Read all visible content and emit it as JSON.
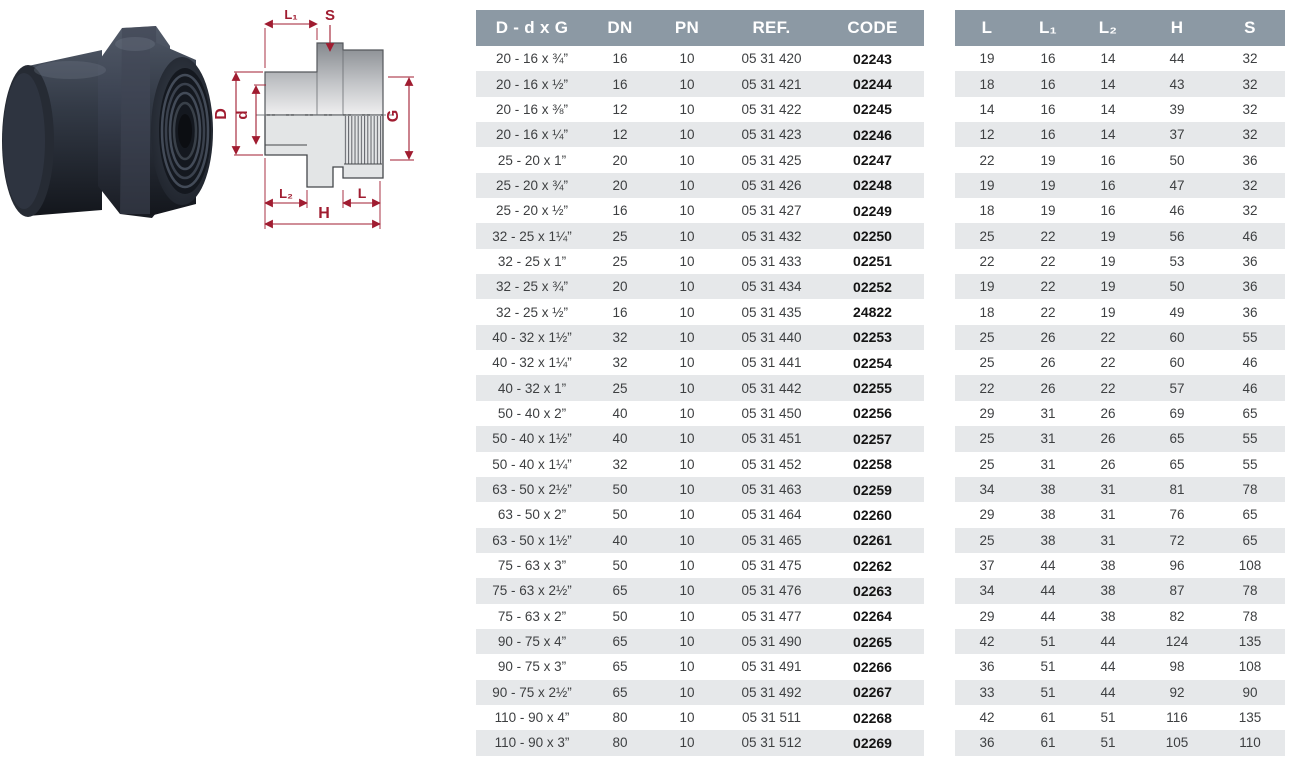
{
  "page": {
    "background": "#ffffff"
  },
  "colors": {
    "table_header_bg": "#8C99A4",
    "row_stripe": "#E6E8EA",
    "cell_text": "#3d3f41",
    "code_text": "#141414",
    "dimension_red": "#A01C30",
    "fitting_dark": "#272C36",
    "drawing_body_gray": "#9DA1A5"
  },
  "drawing": {
    "labels": {
      "l1": "L₁",
      "s": "S",
      "D": "D",
      "d": "d",
      "g": "G",
      "l2": "L₂",
      "l": "L",
      "h": "H"
    }
  },
  "spec_table": {
    "headers": [
      "D - d x G",
      "DN",
      "PN",
      "REF.",
      "CODE"
    ],
    "rows": [
      [
        "20 - 16 x ¾”",
        "16",
        "10",
        "05 31 420",
        "02243"
      ],
      [
        "20 - 16 x ½”",
        "16",
        "10",
        "05 31 421",
        "02244"
      ],
      [
        "20 - 16 x ⅜”",
        "12",
        "10",
        "05 31 422",
        "02245"
      ],
      [
        "20 - 16 x ¼”",
        "12",
        "10",
        "05 31 423",
        "02246"
      ],
      [
        "25 - 20 x 1”",
        "20",
        "10",
        "05 31 425",
        "02247"
      ],
      [
        "25 - 20 x ¾”",
        "20",
        "10",
        "05 31 426",
        "02248"
      ],
      [
        "25 - 20 x ½”",
        "16",
        "10",
        "05 31 427",
        "02249"
      ],
      [
        "32 - 25 x 1¼”",
        "25",
        "10",
        "05 31 432",
        "02250"
      ],
      [
        "32 - 25 x 1”",
        "25",
        "10",
        "05 31 433",
        "02251"
      ],
      [
        "32 - 25 x ¾”",
        "20",
        "10",
        "05 31 434",
        "02252"
      ],
      [
        "32 - 25 x ½”",
        "16",
        "10",
        "05 31 435",
        "24822"
      ],
      [
        "40 - 32 x 1½”",
        "32",
        "10",
        "05 31 440",
        "02253"
      ],
      [
        "40 - 32 x 1¼”",
        "32",
        "10",
        "05 31 441",
        "02254"
      ],
      [
        "40 - 32 x 1”",
        "25",
        "10",
        "05 31 442",
        "02255"
      ],
      [
        "50 - 40 x 2”",
        "40",
        "10",
        "05 31 450",
        "02256"
      ],
      [
        "50 - 40 x 1½”",
        "40",
        "10",
        "05 31 451",
        "02257"
      ],
      [
        "50 - 40 x 1¼”",
        "32",
        "10",
        "05 31 452",
        "02258"
      ],
      [
        "63 - 50 x 2½”",
        "50",
        "10",
        "05 31 463",
        "02259"
      ],
      [
        "63 - 50 x 2”",
        "50",
        "10",
        "05 31 464",
        "02260"
      ],
      [
        "63 - 50 x 1½”",
        "40",
        "10",
        "05 31 465",
        "02261"
      ],
      [
        "75 - 63 x 3”",
        "50",
        "10",
        "05 31 475",
        "02262"
      ],
      [
        "75 - 63 x 2½”",
        "65",
        "10",
        "05 31 476",
        "02263"
      ],
      [
        "75 - 63 x 2”",
        "50",
        "10",
        "05 31 477",
        "02264"
      ],
      [
        "90 - 75 x 4”",
        "65",
        "10",
        "05 31 490",
        "02265"
      ],
      [
        "90 - 75 x 3”",
        "65",
        "10",
        "05 31 491",
        "02266"
      ],
      [
        "90 - 75 x 2½”",
        "65",
        "10",
        "05 31 492",
        "02267"
      ],
      [
        "110 - 90 x 4”",
        "80",
        "10",
        "05 31 511",
        "02268"
      ],
      [
        "110 - 90 x 3”",
        "80",
        "10",
        "05 31 512",
        "02269"
      ]
    ]
  },
  "dim_table": {
    "headers": [
      "L",
      "L₁",
      "L₂",
      "H",
      "S"
    ],
    "rows": [
      [
        19,
        16,
        14,
        44,
        32
      ],
      [
        18,
        16,
        14,
        43,
        32
      ],
      [
        14,
        16,
        14,
        39,
        32
      ],
      [
        12,
        16,
        14,
        37,
        32
      ],
      [
        22,
        19,
        16,
        50,
        36
      ],
      [
        19,
        19,
        16,
        47,
        32
      ],
      [
        18,
        19,
        16,
        46,
        32
      ],
      [
        25,
        22,
        19,
        56,
        46
      ],
      [
        22,
        22,
        19,
        53,
        36
      ],
      [
        19,
        22,
        19,
        50,
        36
      ],
      [
        18,
        22,
        19,
        49,
        36
      ],
      [
        25,
        26,
        22,
        60,
        55
      ],
      [
        25,
        26,
        22,
        60,
        46
      ],
      [
        22,
        26,
        22,
        57,
        46
      ],
      [
        29,
        31,
        26,
        69,
        65
      ],
      [
        25,
        31,
        26,
        65,
        55
      ],
      [
        25,
        31,
        26,
        65,
        55
      ],
      [
        34,
        38,
        31,
        81,
        78
      ],
      [
        29,
        38,
        31,
        76,
        65
      ],
      [
        25,
        38,
        31,
        72,
        65
      ],
      [
        37,
        44,
        38,
        96,
        108
      ],
      [
        34,
        44,
        38,
        87,
        78
      ],
      [
        29,
        44,
        38,
        82,
        78
      ],
      [
        42,
        51,
        44,
        124,
        135
      ],
      [
        36,
        51,
        44,
        98,
        108
      ],
      [
        33,
        51,
        44,
        92,
        90
      ],
      [
        42,
        61,
        51,
        116,
        135
      ],
      [
        36,
        61,
        51,
        105,
        110
      ]
    ]
  }
}
